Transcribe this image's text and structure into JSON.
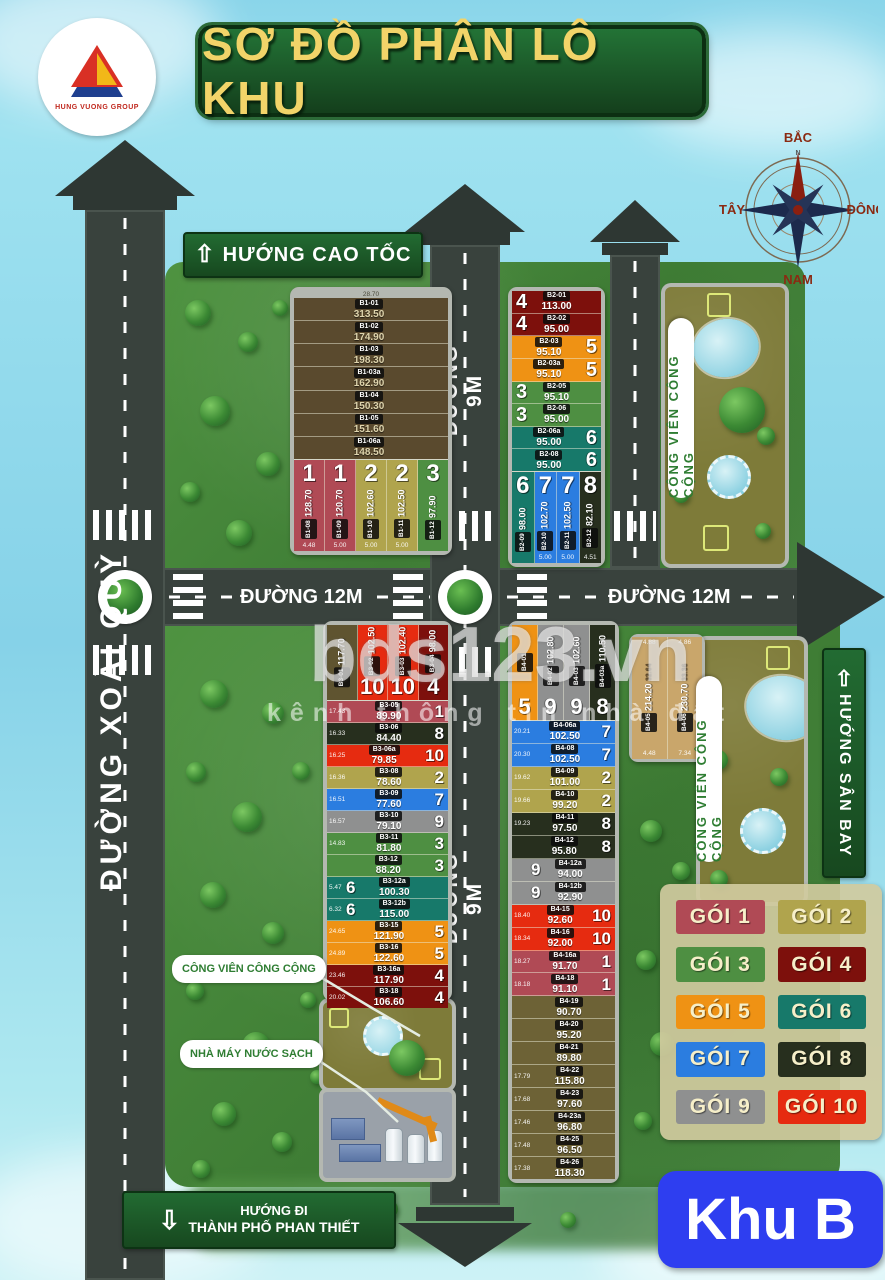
{
  "header": {
    "logo_text": "HUNG VUONG GROUP",
    "title": "SƠ ĐỒ PHÂN LÔ KHU"
  },
  "compass": {
    "north": "BẮC",
    "south": "NAM",
    "west": "TÂY",
    "east": "ĐÔNG",
    "n_letter": "N"
  },
  "signs": {
    "highway": "HƯỚNG CAO TỐC",
    "airport": "HƯỚNG SÂN BAY",
    "city_line1": "HƯỚNG ĐI",
    "city_line2": "THÀNH PHỐ PHAN THIẾT",
    "zone": "Khu B"
  },
  "roads": {
    "left": "ĐƯỜNG XOÀI QUỲ",
    "middle_top": "ĐƯỜNG 9M",
    "middle_bottom": "ĐƯỜNG 9M",
    "h_left": "ĐƯỜNG 12M",
    "h_right": "ĐƯỜNG 12M"
  },
  "labels": {
    "park_top": "CÔNG VIÊN CÔNG CỘNG",
    "park_right": "CÔNG VIÊN CÔNG CỘNG",
    "park_callout": "CÔNG VIÊN CÔNG CỘNG",
    "water_plant": "NHÀ MÁY NƯỚC SẠCH"
  },
  "watermark": {
    "main": "bds123.vn",
    "sub": "kênh thông tin nhà đất"
  },
  "package_colors": {
    "1": "#b04a55",
    "2": "#b0a44d",
    "3": "#4e8f42",
    "4": "#7d100c",
    "5": "#ef9214",
    "6": "#17796a",
    "7": "#2b7de0",
    "8": "#272f1e",
    "9": "#8f9090",
    "10": "#e62b10"
  },
  "extra_colors": {
    "brown": "#5a4a2e",
    "olive": "#6d6236",
    "olive_dark": "#5f5430",
    "tan": "#c9a66b"
  },
  "legend": {
    "items": [
      {
        "label": "GÓI 1",
        "pkg": 1
      },
      {
        "label": "GÓI 2",
        "pkg": 2
      },
      {
        "label": "GÓI 3",
        "pkg": 3
      },
      {
        "label": "GÓI 4",
        "pkg": 4
      },
      {
        "label": "GÓI 5",
        "pkg": 5
      },
      {
        "label": "GÓI 6",
        "pkg": 6
      },
      {
        "label": "GÓI 7",
        "pkg": 7
      },
      {
        "label": "GÓI 8",
        "pkg": 8
      },
      {
        "label": "GÓI 9",
        "pkg": 9
      },
      {
        "label": "GÓI 10",
        "pkg": 10
      }
    ]
  },
  "blocks": {
    "B1": {
      "top_dim": "28.70",
      "top_lots": [
        {
          "id": "B1-01",
          "area": "313.50",
          "color": "brown"
        },
        {
          "id": "B1-02",
          "area": "174.90",
          "color": "brown"
        },
        {
          "id": "B1-03",
          "area": "198.30",
          "color": "brown"
        },
        {
          "id": "B1-03a",
          "area": "162.90",
          "color": "brown"
        },
        {
          "id": "B1-04",
          "area": "150.30",
          "color": "brown"
        },
        {
          "id": "B1-05",
          "area": "151.60",
          "color": "brown"
        },
        {
          "id": "B1-06a",
          "area": "148.50",
          "color": "brown"
        }
      ],
      "bottom_lots": [
        {
          "id": "B1-08",
          "area": "128.70",
          "pkg": 1,
          "dim": "4.48"
        },
        {
          "id": "B1-09",
          "area": "120.70",
          "pkg": 1,
          "dim": "5.00"
        },
        {
          "id": "B1-10",
          "area": "102.60",
          "pkg": 2,
          "dim": "5.00"
        },
        {
          "id": "B1-11",
          "area": "102.50",
          "pkg": 2,
          "dim": "5.00"
        },
        {
          "id": "B1-12",
          "area": "97.90",
          "pkg": 3,
          "dim": ""
        }
      ]
    },
    "B2": {
      "lots": [
        {
          "id": "B2-01",
          "area": "113.00",
          "pkg": 4,
          "side": "left"
        },
        {
          "id": "B2-02",
          "area": "95.00",
          "pkg": 4,
          "side": "left"
        },
        {
          "id": "B2-03",
          "area": "95.10",
          "pkg": 5,
          "side": "right"
        },
        {
          "id": "B2-03a",
          "area": "95.10",
          "pkg": 5,
          "side": "right"
        },
        {
          "id": "B2-05",
          "area": "95.10",
          "pkg": 3,
          "side": "left"
        },
        {
          "id": "B2-06",
          "area": "95.00",
          "pkg": 3,
          "side": "left"
        },
        {
          "id": "B2-06a",
          "area": "95.00",
          "pkg": 6,
          "side": "right"
        },
        {
          "id": "B2-08",
          "area": "95.00",
          "pkg": 6,
          "side": "right"
        }
      ],
      "bottom_lots": [
        {
          "id": "B2-09",
          "area": "98.00",
          "pkg": 6,
          "dim": ""
        },
        {
          "id": "B2-10",
          "area": "102.70",
          "pkg": 7,
          "dim": "5.00"
        },
        {
          "id": "B2-11",
          "area": "102.50",
          "pkg": 7,
          "dim": "5.00"
        },
        {
          "id": "B2-12",
          "area": "82.10",
          "pkg": 8,
          "dim": "4.51"
        }
      ]
    },
    "B3": {
      "top_lots": [
        {
          "id": "B3-01",
          "area": "117.70",
          "color": "olive_dark"
        },
        {
          "id": "B3-02",
          "area": "102.50",
          "pkg": 10
        },
        {
          "id": "B3-03",
          "area": "102.40",
          "pkg": 10
        },
        {
          "id": "B3-04",
          "area": "98.00",
          "pkg": 4
        }
      ],
      "lots": [
        {
          "id": "B3-05",
          "area": "89.90",
          "pkg": 1,
          "dim": "17.43"
        },
        {
          "id": "B3-06",
          "area": "84.40",
          "pkg": 8,
          "dim": "16.33"
        },
        {
          "id": "B3-06a",
          "area": "79.85",
          "pkg": 10,
          "dim": "16.25"
        },
        {
          "id": "B3-08",
          "area": "78.60",
          "pkg": 2,
          "dim": "16.36"
        },
        {
          "id": "B3-09",
          "area": "77.60",
          "pkg": 7,
          "dim": "16.51"
        },
        {
          "id": "B3-10",
          "area": "79.10",
          "pkg": 9,
          "dim": "16.57"
        },
        {
          "id": "B3-11",
          "area": "81.80",
          "pkg": 3,
          "dim": "14.83"
        },
        {
          "id": "B3-12",
          "area": "88.20",
          "pkg": 3,
          "dim": ""
        },
        {
          "id": "B3-12a",
          "area": "100.30",
          "pkg": 6,
          "dim": "5.47",
          "side": "left"
        },
        {
          "id": "B3-12b",
          "area": "115.00",
          "pkg": 6,
          "dim": "6.32",
          "side": "left"
        },
        {
          "id": "B3-15",
          "area": "121.90",
          "pkg": 5,
          "dim": "24.65"
        },
        {
          "id": "B3-16",
          "area": "122.60",
          "pkg": 5,
          "dim": "24.89"
        },
        {
          "id": "B3-16a",
          "area": "117.90",
          "pkg": 4,
          "dim": "23.46"
        },
        {
          "id": "B3-18",
          "area": "106.60",
          "pkg": 4,
          "dim": "20.02"
        }
      ]
    },
    "B4": {
      "top_lots": [
        {
          "id": "B4-01",
          "area": "",
          "pkg": 5
        },
        {
          "id": "B4-02",
          "area": "102.80",
          "pkg": 9
        },
        {
          "id": "B4-03",
          "area": "102.60",
          "pkg": 9
        },
        {
          "id": "B4-03a",
          "area": "110.50",
          "pkg": 8
        }
      ],
      "lots": [
        {
          "id": "B4-06a",
          "area": "102.50",
          "pkg": 7,
          "dim": "20.21"
        },
        {
          "id": "B4-08",
          "area": "102.50",
          "pkg": 7,
          "dim": "20.30"
        },
        {
          "id": "B4-09",
          "area": "101.00",
          "pkg": 2,
          "dim": "19.62"
        },
        {
          "id": "B4-10",
          "area": "99.20",
          "pkg": 2,
          "dim": "19.66"
        },
        {
          "id": "B4-11",
          "area": "97.50",
          "pkg": 8,
          "dim": "19.23"
        },
        {
          "id": "B4-12",
          "area": "95.80",
          "pkg": 8,
          "dim": ""
        },
        {
          "id": "B4-12a",
          "area": "94.00",
          "pkg": 9,
          "dim": "",
          "side": "left"
        },
        {
          "id": "B4-12b",
          "area": "92.90",
          "pkg": 9,
          "dim": "",
          "side": "left"
        },
        {
          "id": "B4-15",
          "area": "92.60",
          "pkg": 10,
          "dim": "18.40"
        },
        {
          "id": "B4-16",
          "area": "92.00",
          "pkg": 10,
          "dim": "18.34"
        },
        {
          "id": "B4-16a",
          "area": "91.70",
          "pkg": 1,
          "dim": "18.27"
        },
        {
          "id": "B4-18",
          "area": "91.10",
          "pkg": 1,
          "dim": "18.18"
        },
        {
          "id": "B4-19",
          "area": "90.70",
          "color": "olive",
          "dim": ""
        },
        {
          "id": "B4-20",
          "area": "95.20",
          "color": "olive",
          "dim": ""
        },
        {
          "id": "B4-21",
          "area": "89.80",
          "color": "olive",
          "dim": ""
        },
        {
          "id": "B4-22",
          "area": "115.80",
          "color": "olive",
          "dim": "17.79"
        },
        {
          "id": "B4-23",
          "area": "97.60",
          "color": "olive",
          "dim": "17.68"
        },
        {
          "id": "B4-23a",
          "area": "96.80",
          "color": "olive",
          "dim": "17.46"
        },
        {
          "id": "B4-25",
          "area": "96.50",
          "color": "olive",
          "dim": "17.48"
        },
        {
          "id": "B4-26",
          "area": "118.30",
          "color": "olive",
          "dim": "17.38"
        }
      ],
      "side_lots": [
        {
          "id": "B4-05",
          "area": "214.20",
          "top": "4.88",
          "bottom": "4.48",
          "sidedim": "32.64",
          "color": "tan"
        },
        {
          "id": "B4-06",
          "area": "230.70",
          "top": "4.86",
          "bottom": "7.34",
          "sidedim": "33.36",
          "color": "tan"
        }
      ]
    }
  }
}
